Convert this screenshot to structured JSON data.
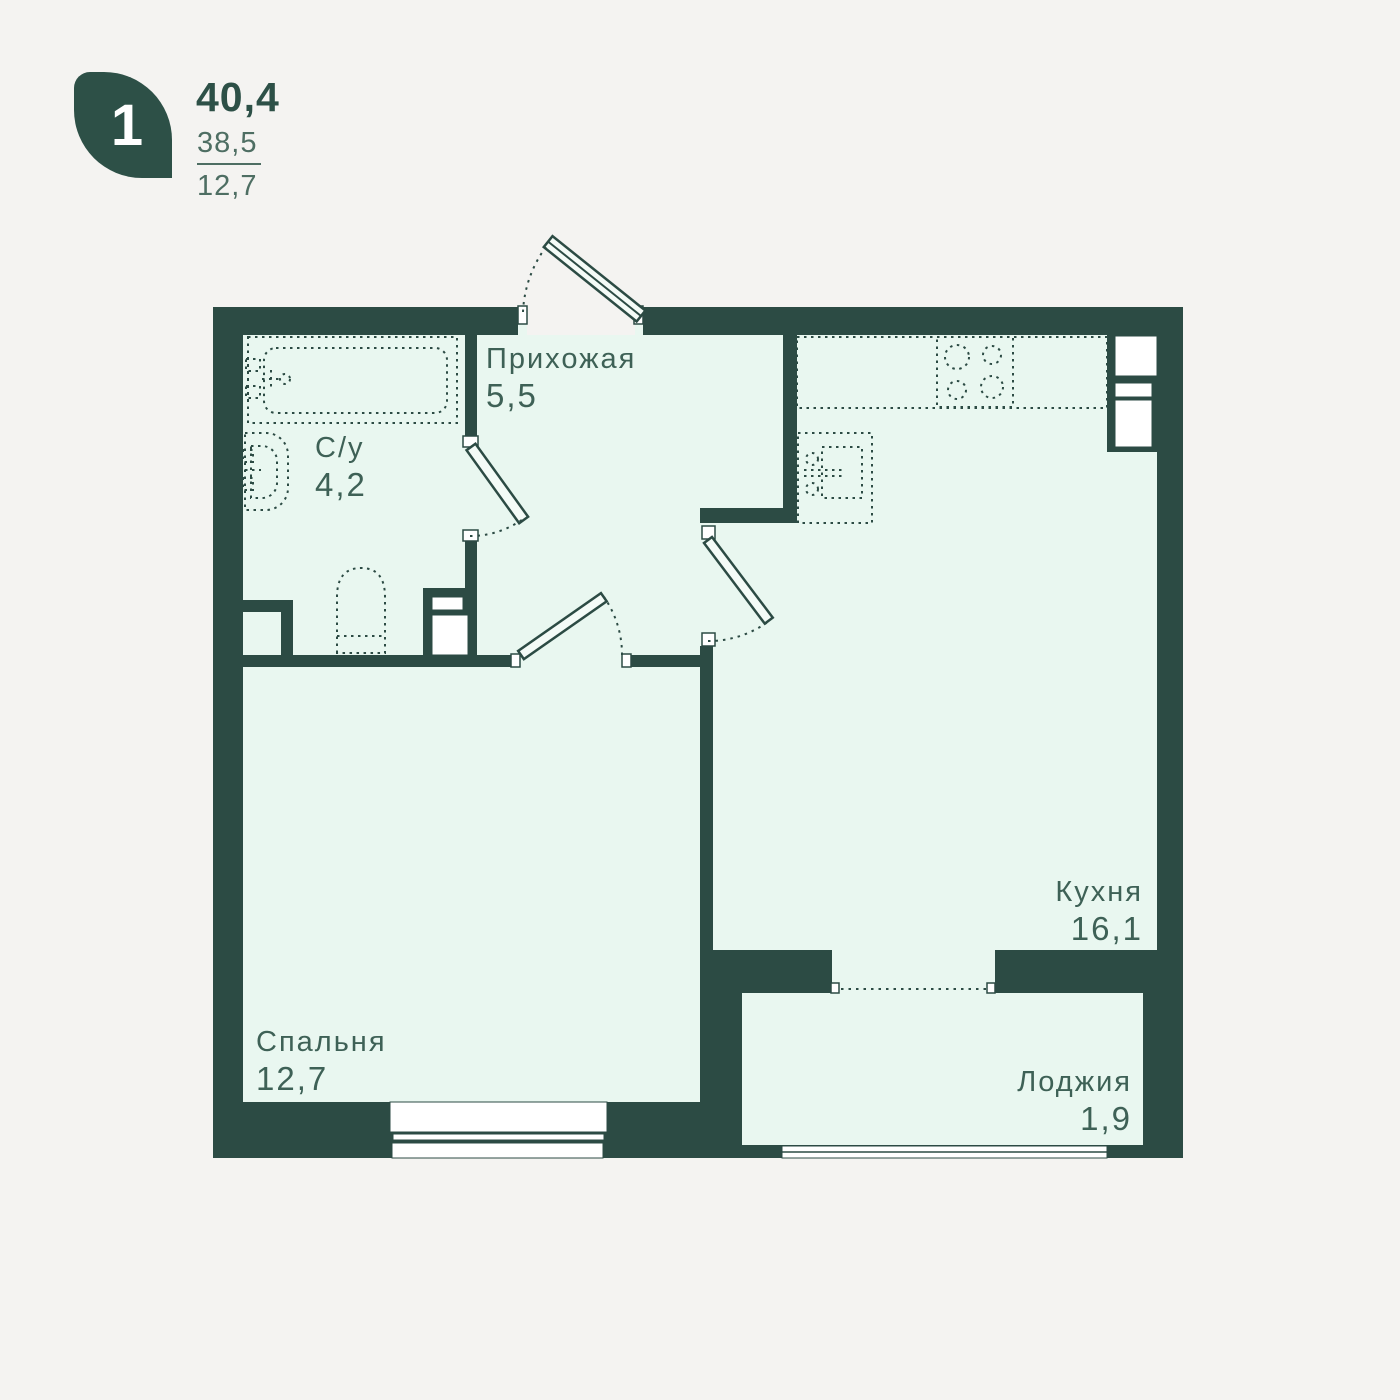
{
  "legend": {
    "unit_rooms": "1",
    "area_total": "40,4",
    "area_living": "38,5",
    "area_room": "12,7"
  },
  "plan": {
    "rooms": [
      {
        "id": "hallway",
        "name": "Прихожая",
        "area": "5,5"
      },
      {
        "id": "bathroom",
        "name": "С/у",
        "area": "4,2"
      },
      {
        "id": "kitchen",
        "name": "Кухня",
        "area": "16,1"
      },
      {
        "id": "bedroom",
        "name": "Спальня",
        "area": "12,7"
      },
      {
        "id": "loggia",
        "name": "Лоджия",
        "area": "1,9"
      }
    ],
    "fixtures": [
      "bathtub",
      "wash-basin",
      "toilet",
      "kitchen-counter",
      "stove",
      "kitchen-sink",
      "ventilation-duct"
    ],
    "colors": {
      "background": "#f4f3f1",
      "wall": "#2c4b44",
      "floor": "#e9f7f0",
      "label": "#3e6156",
      "leaf": "#2d5047",
      "secondary_text": "#4e6e63"
    }
  }
}
